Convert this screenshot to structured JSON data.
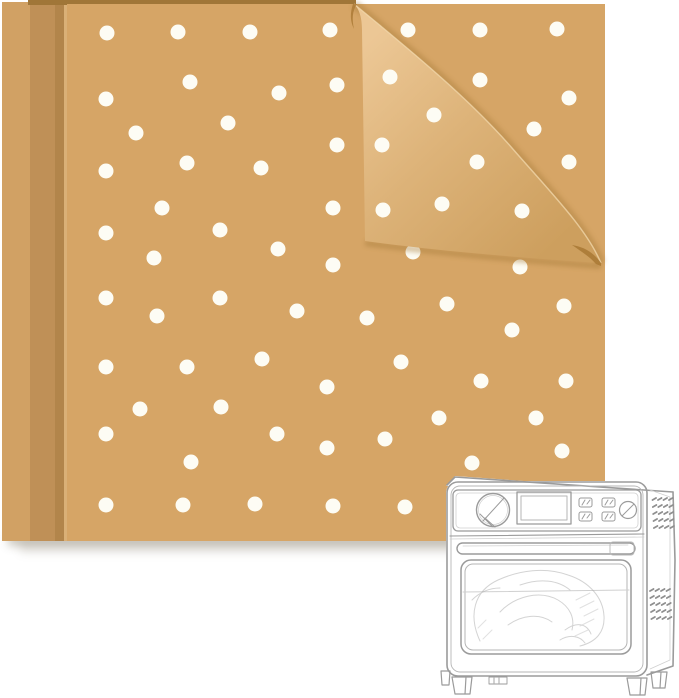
{
  "scene": {
    "description": "Stack of kraft-brown perforated parchment paper sheets covered in white round holes, top-right corner folded over showing the lighter back side, with a light-gray line-art air fryer toaster oven containing a sketched roast chicken in the lower right corner",
    "background_color": "#ffffff"
  },
  "paper_stack": {
    "sheet_color": "#d6a566",
    "sheet_edge_band1_color": "#d1a164",
    "sheet_edge_band2_color": "#bf9057",
    "sheet_edge_band2_dark": "#b2854b",
    "sheet_edge_highlight": "#e3ba82",
    "top_edge_color": "#a07638",
    "flap_gradient": {
      "light": "#ecc795",
      "mid": "#ddb379",
      "dark": "#cd9f5e"
    },
    "flap_edge_highlight": "#f3d9ad",
    "curl_shadow_color": "#ab7a36",
    "fold_cast_shadow_color": "#a57a39",
    "cast_shadow_color": "#8e8675",
    "dot_color": "#fdfcf4",
    "dot_radius": 7.5,
    "main_dots": [
      [
        107,
        33
      ],
      [
        178,
        32
      ],
      [
        250,
        32
      ],
      [
        330,
        30
      ],
      [
        408,
        30
      ],
      [
        480,
        30
      ],
      [
        557,
        29
      ],
      [
        190,
        82
      ],
      [
        279,
        93
      ],
      [
        337,
        85
      ],
      [
        480,
        80
      ],
      [
        569,
        98
      ],
      [
        106,
        99
      ],
      [
        136,
        133
      ],
      [
        228,
        123
      ],
      [
        337,
        145
      ],
      [
        534,
        129
      ],
      [
        187,
        163
      ],
      [
        261,
        168
      ],
      [
        106,
        171
      ],
      [
        569,
        162
      ],
      [
        162,
        208
      ],
      [
        333,
        208
      ],
      [
        220,
        230
      ],
      [
        106,
        233
      ],
      [
        278,
        249
      ],
      [
        333,
        265
      ],
      [
        154,
        258
      ],
      [
        413,
        252
      ],
      [
        520,
        267
      ],
      [
        106,
        298
      ],
      [
        220,
        298
      ],
      [
        297,
        311
      ],
      [
        157,
        316
      ],
      [
        367,
        318
      ],
      [
        447,
        304
      ],
      [
        564,
        306
      ],
      [
        512,
        330
      ],
      [
        106,
        367
      ],
      [
        187,
        367
      ],
      [
        262,
        359
      ],
      [
        327,
        387
      ],
      [
        401,
        362
      ],
      [
        481,
        381
      ],
      [
        566,
        381
      ],
      [
        140,
        409
      ],
      [
        221,
        407
      ],
      [
        277,
        434
      ],
      [
        106,
        434
      ],
      [
        327,
        448
      ],
      [
        439,
        418
      ],
      [
        536,
        418
      ],
      [
        385,
        439
      ],
      [
        562,
        451
      ],
      [
        191,
        462
      ],
      [
        472,
        463
      ],
      [
        106,
        505
      ],
      [
        183,
        505
      ],
      [
        255,
        504
      ],
      [
        333,
        506
      ],
      [
        405,
        507
      ]
    ],
    "flap_dots": [
      [
        390,
        77
      ],
      [
        434,
        115
      ],
      [
        382,
        145
      ],
      [
        477,
        162
      ],
      [
        442,
        204
      ],
      [
        383,
        210
      ],
      [
        522,
        211
      ]
    ]
  },
  "oven_sketch": {
    "line_color": "#9b9b9b",
    "mid_line_color": "#b5b5b5",
    "light_line_color": "#d0d0d0",
    "vent_color": "#8f8f8f",
    "sketch_color": "#a9a9a9",
    "fill_color": "#ffffff"
  }
}
